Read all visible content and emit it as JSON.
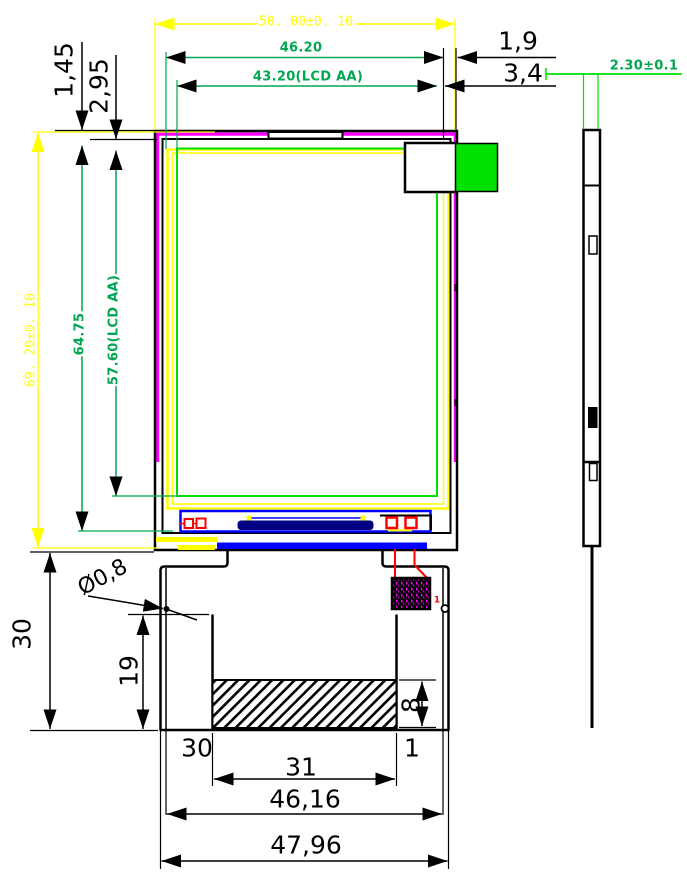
{
  "title": "LCD module outline drawing",
  "colors": {
    "dim_yellow": "#FFFF00",
    "dim_green": "#00A651",
    "bright_green": "#00E100",
    "polarizer_magenta": "#FF00FF",
    "ito_blue": "#0000FF",
    "driver_ic_navy": "#000080",
    "component_red": "#FF0000",
    "line_black": "#000000"
  },
  "dims": {
    "module_width": {
      "text": "50. 00±0. 10"
    },
    "pol_width": {
      "text": "46.20"
    },
    "aa_width": {
      "text": "43.20(LCD AA)"
    },
    "edge_1_9": {
      "text": "1,9"
    },
    "edge_3_4": {
      "text": "3,4"
    },
    "thickness": {
      "text": "2.30±0.1"
    },
    "edge_1_45": {
      "text": "1,45"
    },
    "edge_2_95": {
      "text": "2,95"
    },
    "module_height": {
      "text": "69. 20±0. 10"
    },
    "pol_height": {
      "text": "64.75"
    },
    "aa_height": {
      "text": "57.60(LCD AA)"
    },
    "hole_dia": {
      "text": "Ø0,8"
    },
    "fpc_len_30": {
      "text": "30"
    },
    "fpc_len_19": {
      "text": "19"
    },
    "contact_h_8": {
      "text": "8"
    },
    "contact_w_31": {
      "text": "31"
    },
    "fpc_w_46_16": {
      "text": "46,16"
    },
    "fpc_w_47_96": {
      "text": "47,96"
    },
    "pin_30": {
      "text": "30"
    },
    "pin_1": {
      "text": "1"
    },
    "ref_1": {
      "text": "1"
    }
  }
}
